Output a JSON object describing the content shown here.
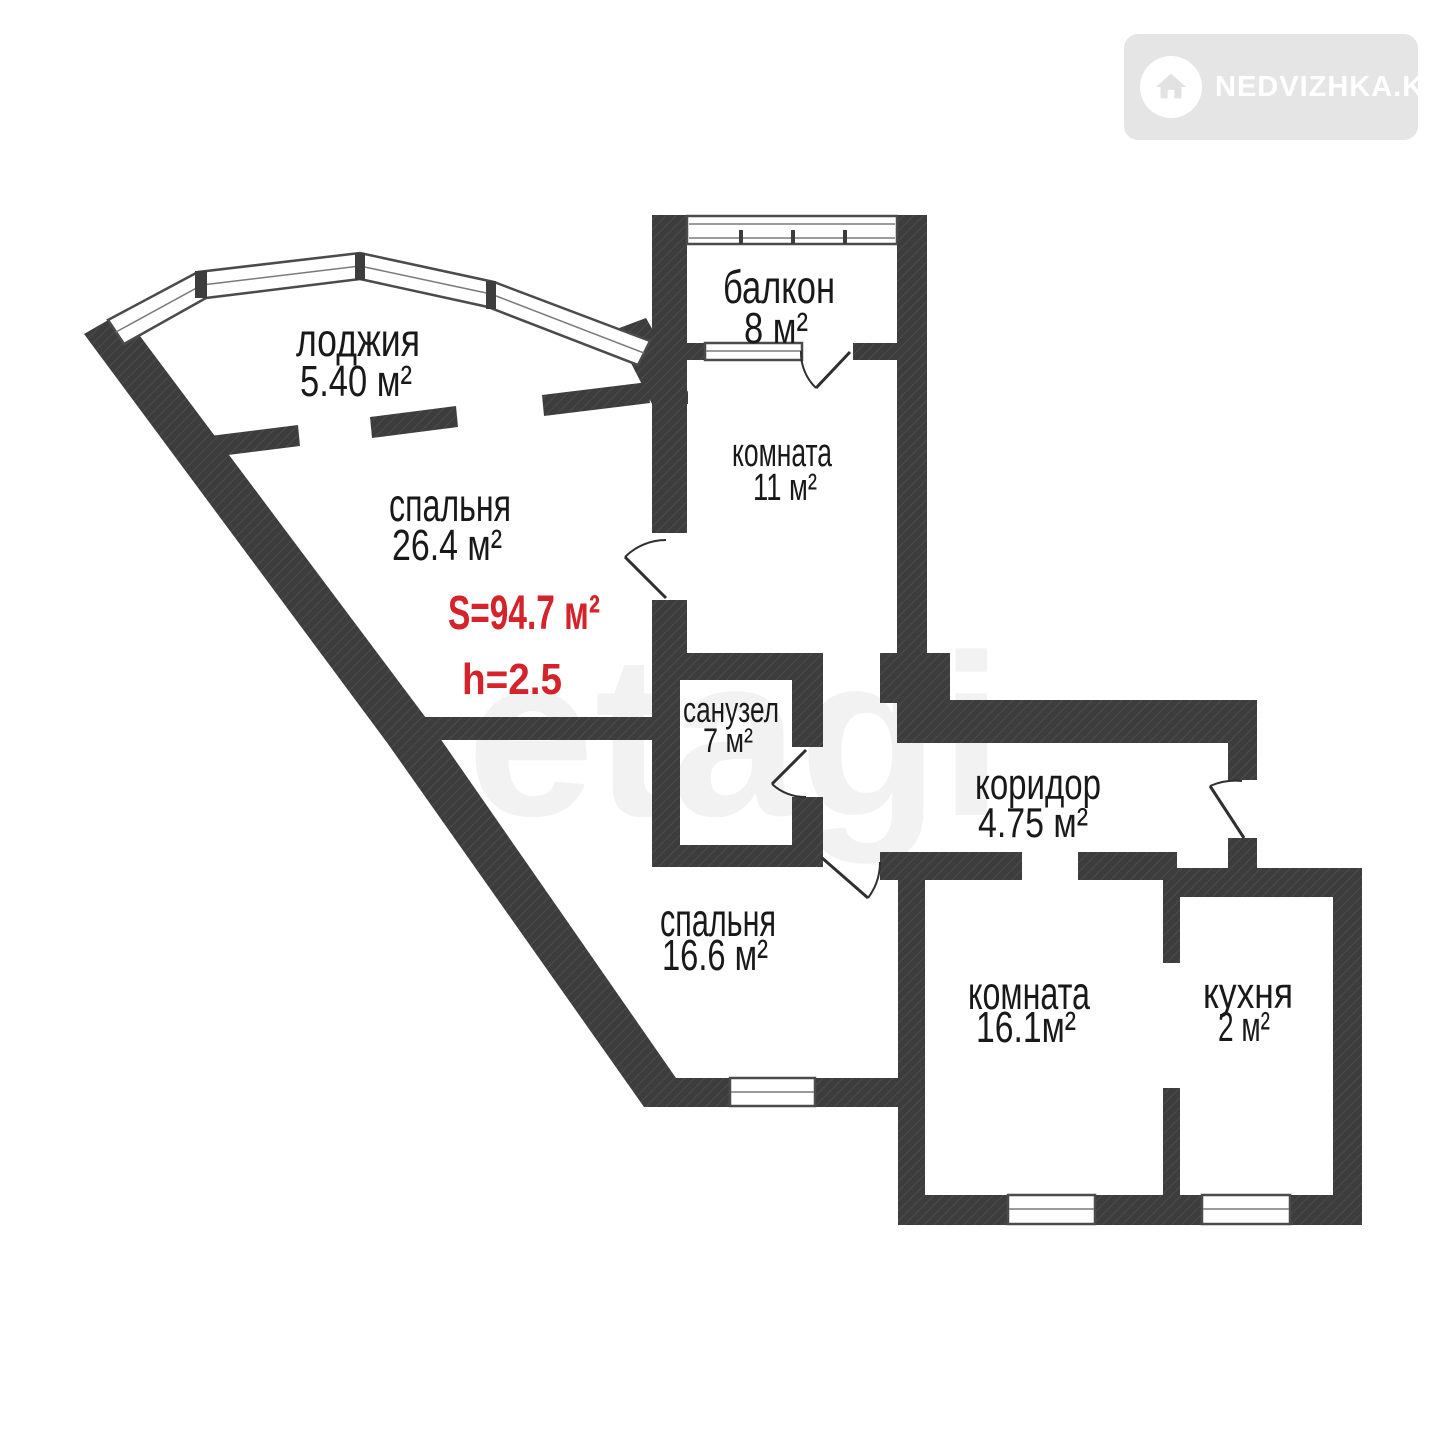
{
  "logo": {
    "text": "NEDVIZHKA.KZ",
    "badge_color": "#e5e5e5",
    "text_color": "#ffffff",
    "icon": "house-in-circle"
  },
  "watermark": "etagi",
  "plan": {
    "wall_color": "#3d3d3d",
    "accent_color": "#d4232b",
    "total_area_label": "S=94.7 м²",
    "ceiling_height_label": "h=2.5",
    "rooms": [
      {
        "name": "лоджия",
        "area": "5.40 м²"
      },
      {
        "name": "балкон",
        "area": "8 м²"
      },
      {
        "name": "спальня",
        "area": "26.4 м²"
      },
      {
        "name": "комната",
        "area": "11 м²"
      },
      {
        "name": "санузел",
        "area": "7 м²"
      },
      {
        "name": "коридор",
        "area": "4.75 м²"
      },
      {
        "name": "спальня",
        "area": "16.6 м²"
      },
      {
        "name": "комната",
        "area": "16.1м²"
      },
      {
        "name": "кухня",
        "area": "2 м²"
      }
    ]
  }
}
